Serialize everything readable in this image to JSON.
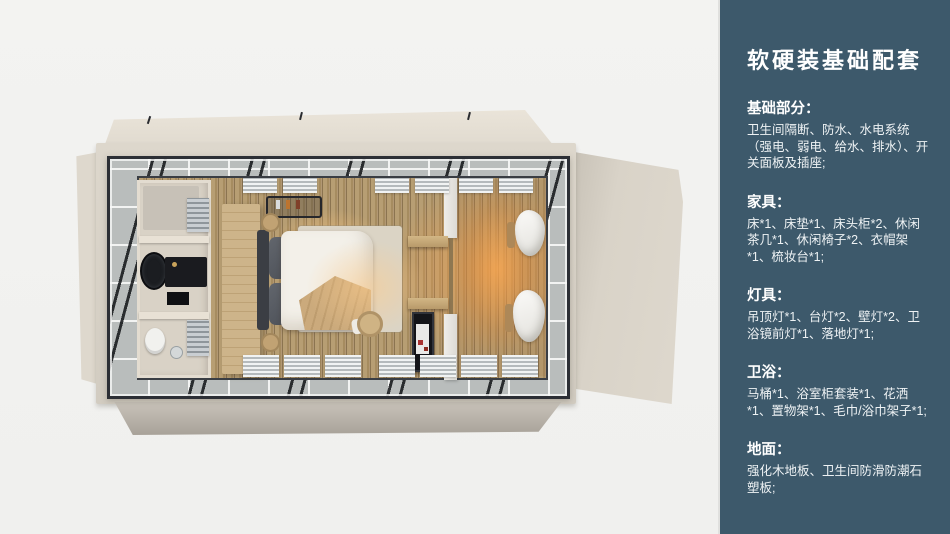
{
  "page": {
    "background": "#f2f2f0"
  },
  "sidebar": {
    "background": "#3d596b",
    "text_color": "#ffffff",
    "title": "软硬装基础配套",
    "sections": [
      {
        "heading": "基础部分：",
        "body": "卫生间隔断、防水、水电系统（强电、弱电、给水、排水）、开关面板及插座;"
      },
      {
        "heading": "家具：",
        "body": "床*1、床垫*1、床头柜*2、休闲茶几*1、休闲椅子*2、衣帽架*1、梳妆台*1;"
      },
      {
        "heading": "灯具：",
        "body": "吊顶灯*1、台灯*2、壁灯*2、卫浴镜前灯*1、落地灯*1;"
      },
      {
        "heading": "卫浴：",
        "body": "马桶*1、浴室柜套装*1、花洒*1、置物架*1、毛巾/浴巾架子*1;"
      },
      {
        "heading": "地面：",
        "body": "强化木地板、卫生间防滑防潮石塑板;"
      }
    ]
  },
  "render_palette": {
    "deck_beige": "#d8d2c8",
    "frame_steel": "#2c2f35",
    "glass_band": "#b9bdbc",
    "wood_floor": "#b59c72",
    "warm_glow": "#ffaa50",
    "bathroom_wall": "#d9d2c6"
  }
}
